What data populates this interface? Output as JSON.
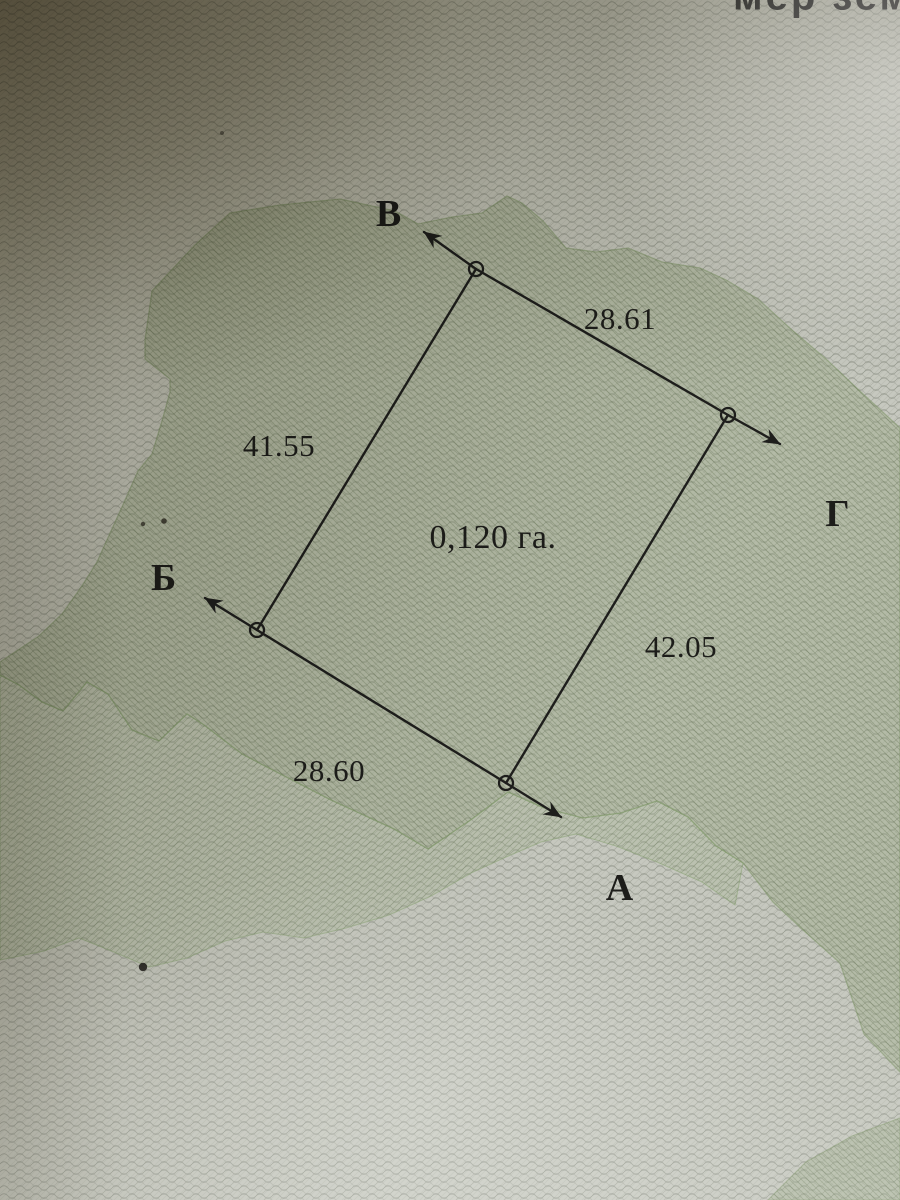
{
  "header": {
    "clipped_text": "мер зем"
  },
  "plan": {
    "area_label": "0,120 га.",
    "vertices": {
      "a": "А",
      "b": "Б",
      "v": "В",
      "g": "Г"
    },
    "side_lengths": {
      "v_g": "28.61",
      "b_v": "41.55",
      "a_g": "42.05",
      "a_b": "28.60"
    }
  },
  "colors": {
    "ink": "#1d1d1a",
    "paper": "#c6c8bf",
    "map_green": "#8ea177",
    "band_green": "#9fb089",
    "shadow_brown": "#6b6353"
  }
}
